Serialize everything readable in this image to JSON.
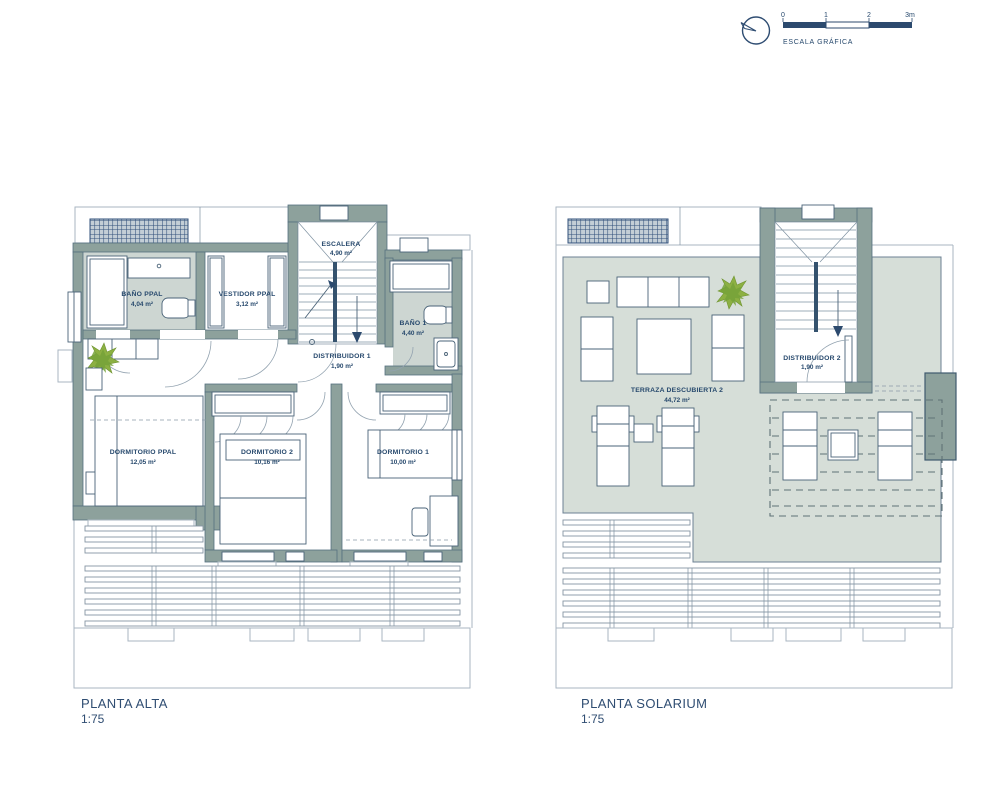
{
  "palette": {
    "line_navy": "#2c4a6e",
    "wall_sage": "#8da19c",
    "bath_floor": "#cdd6d2",
    "terrace_floor": "#d6ded8",
    "hatch_blue": "#31507b",
    "plant_green": "#86ab3e",
    "text_navy": "#27496d"
  },
  "scale_graphic": {
    "ticks": [
      "0",
      "1",
      "2",
      "3m"
    ],
    "caption": "ESCALA GRÁFICA"
  },
  "plans": {
    "alta": {
      "title": "PLANTA ALTA",
      "scale": "1:75",
      "rooms": [
        {
          "name": "BAÑO PPAL",
          "area": "4,04 m²"
        },
        {
          "name": "VESTIDOR PPAL",
          "area": "3,12 m²"
        },
        {
          "name": "ESCALERA",
          "area": "4,90 m²"
        },
        {
          "name": "BAÑO 1",
          "area": "4,40 m²"
        },
        {
          "name": "DISTRIBUIDOR 1",
          "area": "1,90 m²"
        },
        {
          "name": "DORMITORIO PPAL",
          "area": "12,05 m²"
        },
        {
          "name": "DORMITORIO 2",
          "area": "10,16 m²"
        },
        {
          "name": "DORMITORIO 1",
          "area": "10,00 m²"
        }
      ]
    },
    "solarium": {
      "title": "PLANTA SOLARIUM",
      "scale": "1:75",
      "rooms": [
        {
          "name": "DISTRIBUIDOR 2",
          "area": "1,90 m²"
        },
        {
          "name": "TERRAZA DESCUBIERTA 2",
          "area": "44,72 m²"
        }
      ]
    }
  }
}
